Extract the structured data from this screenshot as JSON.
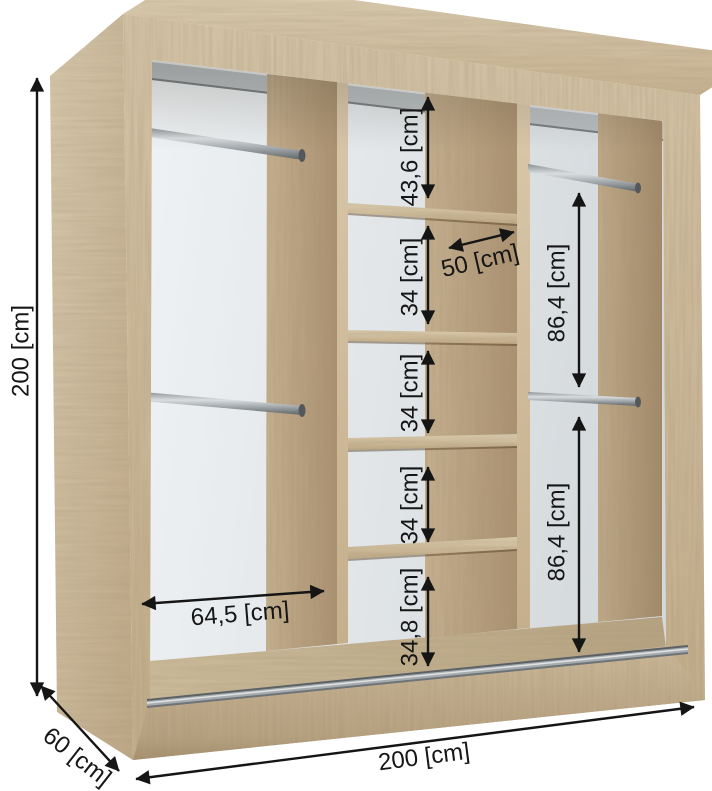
{
  "diagram": {
    "type": "furniture-dimension-diagram",
    "subject": "sliding-door wardrobe interior with shelves and hanging rails",
    "unit": "cm",
    "dimensions": {
      "height": "200 [cm]",
      "width": "200 [cm]",
      "depth": "60 [cm]",
      "left_section_width": "64,5 [cm]",
      "center_section_width": "50 [cm]",
      "center_compartments": [
        "43,6 [cm]",
        "34 [cm]",
        "34 [cm]",
        "34 [cm]",
        "34,8 [cm]"
      ],
      "right_sections": [
        "86,4 [cm]",
        "86,4 [cm]"
      ]
    },
    "elements": {
      "left_section": "two hanging rails",
      "center_section": "five shelf compartments",
      "right_section": "two hanging rails",
      "base": "double sliding-door track"
    },
    "colors": {
      "wood_light": "#d7c6a9",
      "wood_medium": "#c3ad8c",
      "wood_dark": "#a98f6c",
      "back_panel": "#e9edf0",
      "metal": "#9aa0a4",
      "dimension_ink": "#151515",
      "background": "#ffffff"
    }
  }
}
